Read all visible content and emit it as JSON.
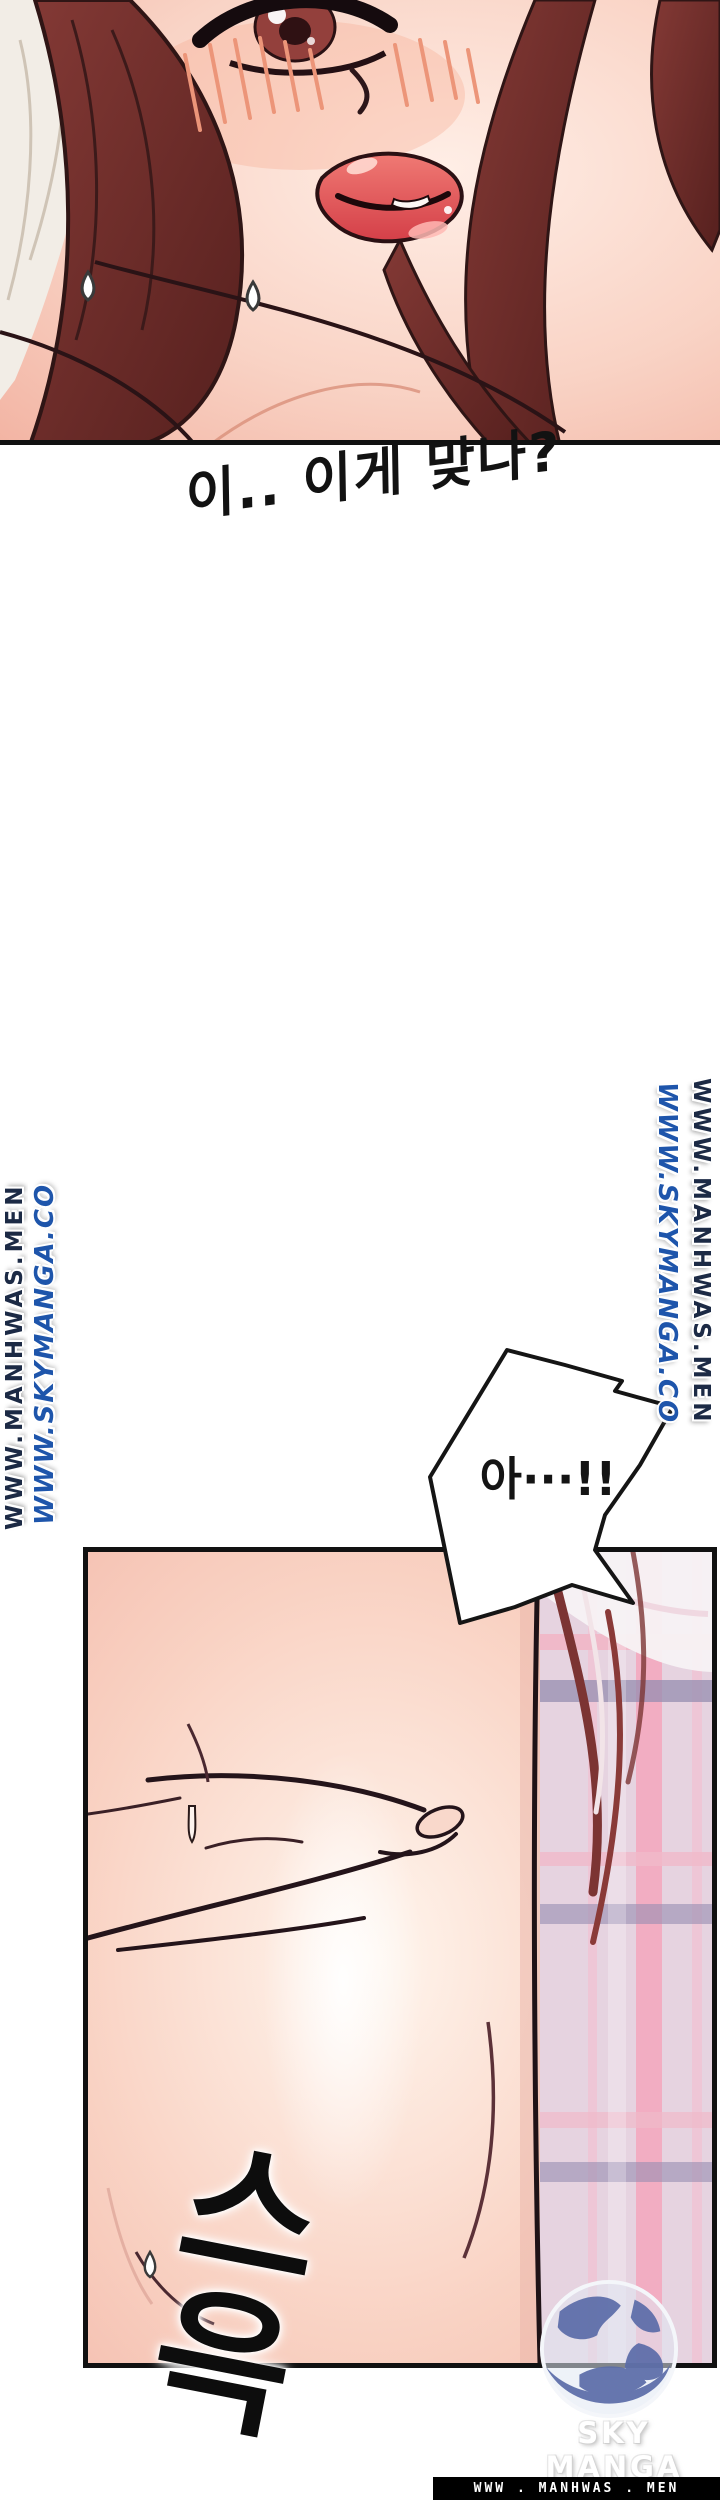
{
  "page": {
    "width": 720,
    "height": 2500
  },
  "panel1": {
    "caption": "이.. 이게 맞나?"
  },
  "watermarks": {
    "manhwas": "WWW.MANHWAS.MEN",
    "skymanga": "WWW.SKYMANGA.CO"
  },
  "bubble": {
    "text": "아···!!"
  },
  "panel2": {
    "sfx": "스윽"
  },
  "logo": {
    "label": "SKY MANGA"
  },
  "footer": {
    "text": "WWW . MANHWAS . MEN"
  },
  "colors": {
    "watermark_manhwas": "#1c2a45",
    "watermark_skymanga": "#1e55ab",
    "footer_bg": "#000000",
    "footer_text": "#ffffff",
    "ink": "#131313",
    "skin_light": "#ffeee6",
    "skin_mid": "#f6c9ba",
    "hair": "#76312e",
    "plaid_base": "#e6d3e0",
    "plaid_pink": "#f3a9bf",
    "plaid_slate": "#968eb0",
    "lip": "#d94a50",
    "globe_blue": "#5b6ca8"
  }
}
